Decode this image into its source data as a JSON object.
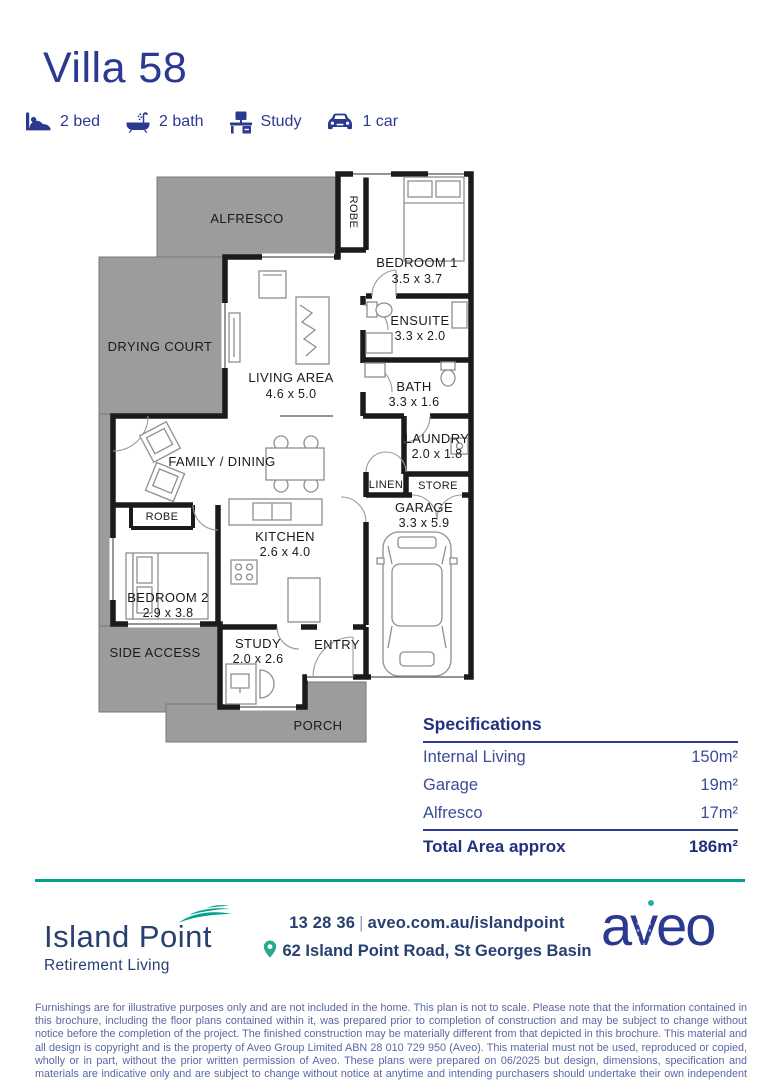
{
  "title": "Villa 58",
  "features": [
    {
      "icon": "bed-icon",
      "label": "2 bed"
    },
    {
      "icon": "bath-icon",
      "label": "2 bath"
    },
    {
      "icon": "study-icon",
      "label": "Study"
    },
    {
      "icon": "car-icon",
      "label": "1 car"
    }
  ],
  "plan": {
    "rooms": {
      "alfresco": {
        "name": "ALFRESCO"
      },
      "robe1": {
        "name": "ROBE"
      },
      "bedroom1": {
        "name": "BEDROOM 1",
        "dims": "3.5 x 3.7"
      },
      "drying_court": {
        "name": "DRYING COURT"
      },
      "living_area": {
        "name": "LIVING AREA",
        "dims": "4.6 x 5.0"
      },
      "ensuite": {
        "name": "ENSUITE",
        "dims": "3.3 x 2.0"
      },
      "bath": {
        "name": "BATH",
        "dims": "3.3 x 1.6"
      },
      "family_dining": {
        "name": "FAMILY / DINING"
      },
      "laundry": {
        "name": "LAUNDRY",
        "dims": "2.0 x 1.8"
      },
      "linen": {
        "name": "LINEN"
      },
      "store": {
        "name": "STORE"
      },
      "robe2": {
        "name": "ROBE"
      },
      "garage": {
        "name": "GARAGE",
        "dims": "3.3 x 5.9"
      },
      "kitchen": {
        "name": "KITCHEN",
        "dims": "2.6 x 4.0"
      },
      "bedroom2": {
        "name": "BEDROOM 2",
        "dims": "2.9 x 3.8"
      },
      "side_access": {
        "name": "SIDE ACCESS"
      },
      "study": {
        "name": "STUDY",
        "dims": "2.0 x 2.6"
      },
      "entry": {
        "name": "ENTRY"
      },
      "porch": {
        "name": "PORCH"
      }
    }
  },
  "specifications": {
    "heading": "Specifications",
    "rows": [
      {
        "label": "Internal Living",
        "value": "150m²"
      },
      {
        "label": "Garage",
        "value": "19m²"
      },
      {
        "label": "Alfresco",
        "value": "17m²"
      }
    ],
    "total_label": "Total Area approx",
    "total_value": "186m²"
  },
  "footer": {
    "brand": {
      "name": "Island Point",
      "tagline": "Retirement Living"
    },
    "contact": {
      "phone": "13 28 36",
      "separator": "|",
      "website": "aveo.com.au/islandpoint",
      "address": "62 Island Point Road, St Georges Basin"
    },
    "logo_text": "aveo",
    "disclaimer": "Furnishings are for illustrative purposes only and are not included in the home. This plan is not to scale. Please note that the information contained in this brochure, including the floor plans contained within it, was prepared prior to completion of construction and may be subject to change without notice before the completion of the project. The finished construction may be materially different from that depicted in this brochure. This material and all design is copyright and is the property of Aveo Group Limited ABN 28 010 729 950 (Aveo). This material must not be used, reproduced or copied, wholly or in part, without the prior written permission of Aveo. These plans were prepared on 06/2025 but design, dimensions, specification and materials are indicative only and are subject to change without notice at anytime and intending purchasers should undertake their own independent inquiries to satisfy themselves regarding the status of these plans. You should refer to appropriate Survey Plans for confirmation of individual unit areas."
  },
  "colors": {
    "navy": "#2B3990",
    "footer_navy": "#27406F",
    "teal_line": "#00A18F",
    "pin_green": "#2BA98B",
    "plan_outdoor_gray": "#9C9C9C",
    "wall_black": "#1B1B1B",
    "disclaimer_blue": "#5B67A5"
  }
}
